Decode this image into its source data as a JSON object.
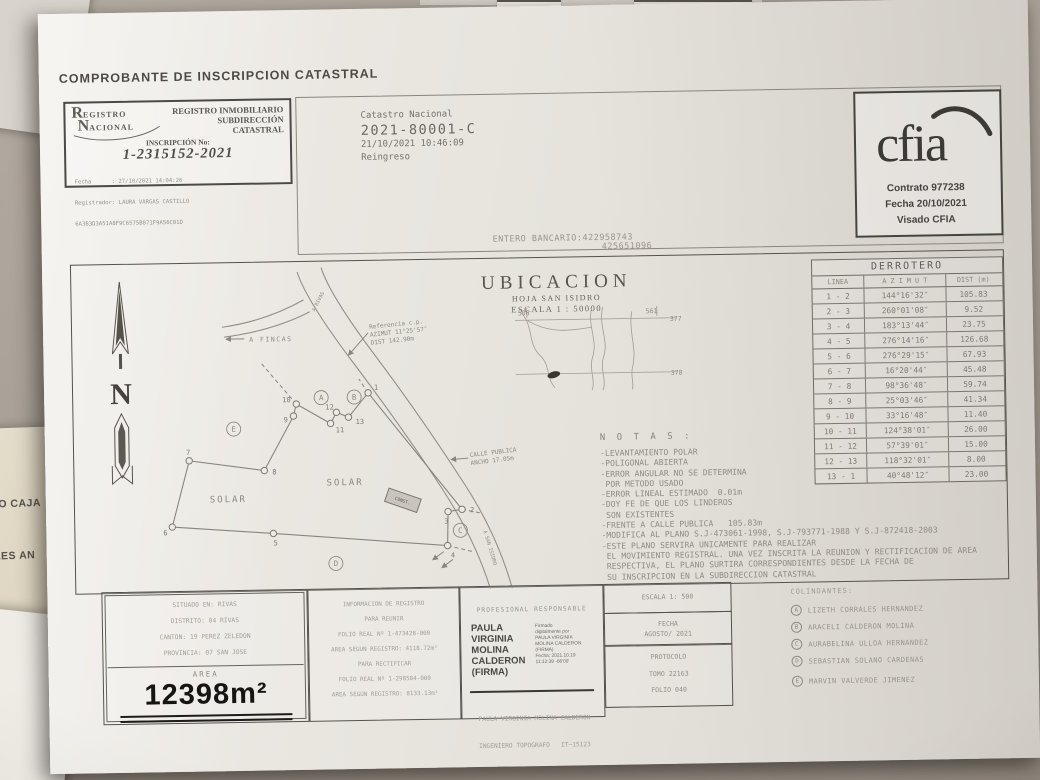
{
  "document": {
    "heading": "COMPROBANTE DE INSCRIPCION CATASTRAL"
  },
  "stamp": {
    "logo_big1": "R",
    "logo_rest1": "EGISTRO",
    "logo_big2": "N",
    "logo_rest2": "ACIONAL",
    "dept_line1": "REGISTRO INMOBILIARIO",
    "dept_line2": "SUBDIRECCIÓN",
    "dept_line3": "CATASTRAL",
    "inscripcion_label": "INSCRIPCIÓN No:",
    "inscripcion_number": "1-2315152-2021",
    "fecha": "Fecha      : 27/10/2021 14:04:26",
    "registrador": "Registrador: LAURA VARGAS CASTILLO",
    "codigo": "6A3B3D3A51A8F9C6575B871F9A56C01D"
  },
  "catastro": {
    "titulo": "Catastro Nacional",
    "numero": "2021-80001-C",
    "fecha_hora": "21/10/2021 10:46:09",
    "estado": "Reingreso"
  },
  "cfia": {
    "logo_text": "cfia",
    "contrato": "Contrato 977238",
    "fecha": "Fecha 20/10/2021",
    "visado": "Visado CFIA"
  },
  "entero_bancario": {
    "linea1": "ENTERO BANCARIO:422958743",
    "linea2": "425651096"
  },
  "ubicacion": {
    "titulo": "UBICACION",
    "hoja": "HOJA SAN ISIDRO",
    "escala": "ESCALA 1 : 50000",
    "grid_izq": "506",
    "grid_der": "561",
    "grid_lat_sup": "377",
    "grid_lat_inf": "378"
  },
  "plan": {
    "norte": "N",
    "a_fincas": "A FINCAS",
    "ref_l1": "Referencia c.p.",
    "ref_l2": "AZIMUT 11°25'57″",
    "ref_l3": "DIST 142.90m",
    "calle_l1": "CALLE PUBLICA",
    "calle_l2": "ANCHO 17.05m",
    "solar_1": "SOLAR",
    "solar_2": "SOLAR",
    "via_inferior": "A SAN ISIDRO",
    "via_superior": "A RIVAS",
    "casa": "CONST.",
    "vertices": [
      "1",
      "2",
      "3",
      "4",
      "5",
      "6",
      "7",
      "8",
      "9",
      "10",
      "11",
      "12",
      "13"
    ],
    "colindancia_letras": [
      "A",
      "B",
      "C",
      "D",
      "E"
    ]
  },
  "derrotero": {
    "titulo": "DERROTERO",
    "headers": [
      "LINEA",
      "A Z I M U T",
      "DIST (m)"
    ],
    "rows": [
      [
        "1 - 2",
        "144°16'32″",
        "105.83"
      ],
      [
        "2 - 3",
        "260°01'08″",
        "9.52"
      ],
      [
        "3 - 4",
        "183°13'44″",
        "23.75"
      ],
      [
        "4 - 5",
        "276°14'16″",
        "126.68"
      ],
      [
        "5 - 6",
        "276°29'15″",
        "67.93"
      ],
      [
        "6 - 7",
        "16°20'44″",
        "45.48"
      ],
      [
        "7 - 8",
        "98°36'48″",
        "59.74"
      ],
      [
        "8 - 9",
        "25°03'46″",
        "41.34"
      ],
      [
        "9 - 10",
        "33°16'48″",
        "11.40"
      ],
      [
        "10 - 11",
        "124°38'01″",
        "26.00"
      ],
      [
        "11 - 12",
        "57°39'01″",
        "15.00"
      ],
      [
        "12 - 13",
        "118°32'01″",
        "8.00"
      ],
      [
        "13 - 1",
        "40°48'12″",
        "23.00"
      ]
    ]
  },
  "notas": {
    "titulo": "N O T A S :",
    "lineas": [
      "-LEVANTAMIENTO POLAR",
      "-POLIGONAL ABIERTA",
      "-ERROR ANGULAR NO SE DETERMINA",
      " POR METODO USADO",
      "-ERROR LINEAL ESTIMADO  0.01m",
      "-DOY FE DE QUE LOS LINDEROS",
      " SON EXISTENTES",
      "-FRENTE A CALLE PUBLICA   105.83m",
      "-MODIFICA AL PLANO S.J-473061-1998, S.J-793771-1988 Y S.J-872418-2003",
      "-ESTE PLANO SERVIRA UNICAMENTE PARA REALIZAR",
      " EL MOVIMIENTO REGISTRAL. UNA VEZ INSCRITA LA REUNION Y RECTIFICACION DE AREA",
      " RESPECTIVA, EL PLANO SURTIRA CORRESPONDIENTES DESDE LA FECHA DE",
      " SU INSCRIPCION EN LA SUBDIRECCION CATASTRAL"
    ]
  },
  "situado": {
    "lineas": [
      "SITUADO EN: RIVAS",
      "DISTRITO: 04 RIVAS",
      "CANTON: 19 PEREZ ZELEDON",
      "PROVINCIA: 07 SAN JOSE"
    ],
    "area_label": "AREA",
    "area_valor": "12398m²"
  },
  "registro_info": {
    "lineas": [
      "INFORMACION DE REGISTRO",
      "PARA REUNIR",
      "FOLIO REAL Nº 1-473428-000",
      "AREA SEGUN REGISTRO: 4118.72m²",
      "PARA RECTIFICAR",
      "FOLIO REAL Nº 1-298584-000",
      "AREA SEGUN REGISTRO: 8133.13m²"
    ]
  },
  "profesional": {
    "titulo": "PROFESIONAL RESPONSABLE",
    "nombre_lineas": [
      "PAULA",
      "VIRGINIA",
      "MOLINA",
      "CALDERON",
      "(FIRMA)"
    ],
    "firma_lineas": [
      "Firmado",
      "digitalmente por",
      "PAULA VIRGINIA",
      "MOLINA CALDERON",
      "(FIRMA)",
      "Fecha: 2021.10.19",
      "11:12:39 -06'00'"
    ],
    "pie_1": "PAULA VIRGINIA MOLINA CALDERON",
    "pie_2": "INGENIERO TOPOGRAFO   IT—15123"
  },
  "cuadros": {
    "escala": "ESCALA 1: 500",
    "fecha_label": "FECHA",
    "fecha_valor": "AGOSTO/ 2021",
    "protocolo": "PROTOCOLO",
    "tomo": "TOMO 22163",
    "folio": "FOLIO 040"
  },
  "colindantes": {
    "titulo": "COLINDANTES:",
    "items": [
      {
        "letra": "A",
        "nombre": "LIZETH CORRALES HERNANDEZ"
      },
      {
        "letra": "B",
        "nombre": "ARACELI CALDERON MOLINA"
      },
      {
        "letra": "C",
        "nombre": "AURABELINA ULLOA HERNANDEZ"
      },
      {
        "letra": "D",
        "nombre": "SEBASTIAN SOLANO CARDENAS"
      },
      {
        "letra": "E",
        "nombre": "MARVIN VALVERDE JIMENEZ"
      }
    ]
  },
  "fragmentos_fondo": {
    "f1": "O CAJA",
    "f2": "LES AN",
    "f3": "MA SOL"
  },
  "colors": {
    "paper": "#eae7e1",
    "ink_dark": "#3f3d39",
    "ink_faint": "#8f8b84",
    "ink_plan": "#8a867f"
  }
}
